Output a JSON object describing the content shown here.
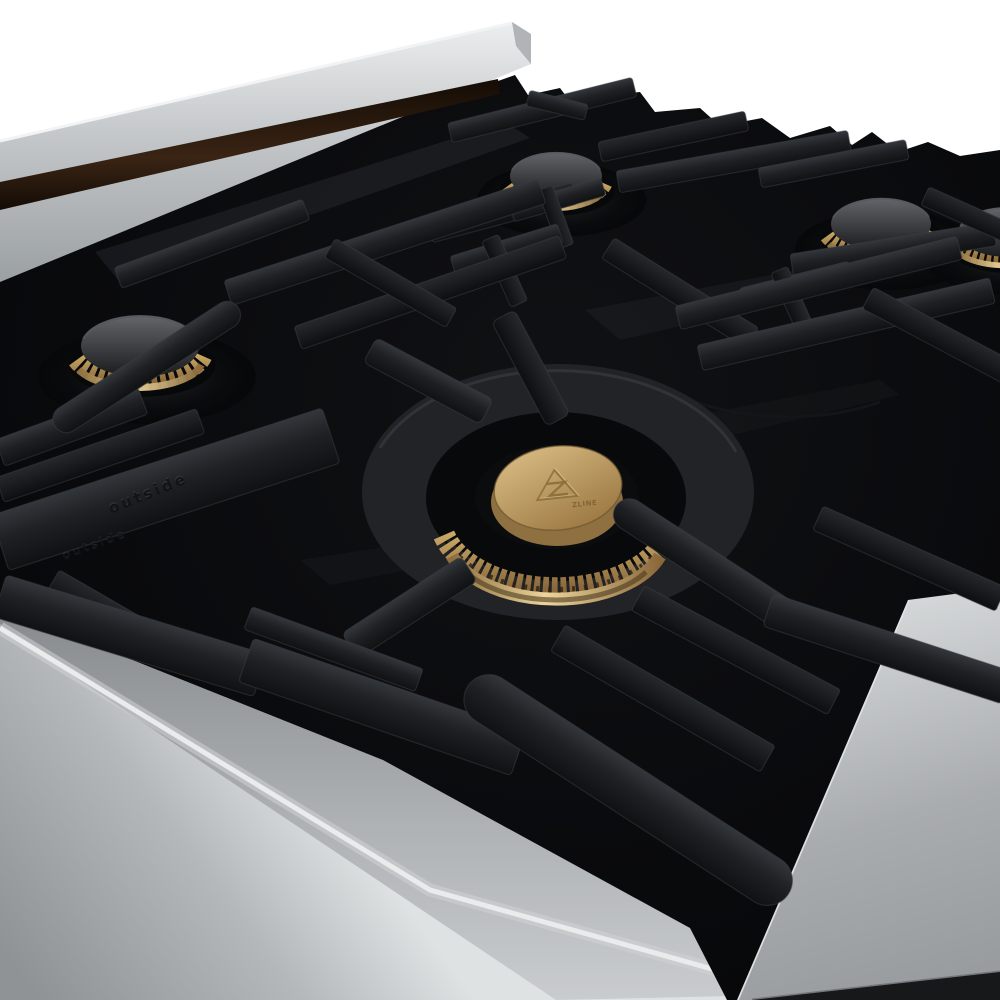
{
  "meta": {
    "description": "Close-up product photograph of a stainless steel gas rangetop with a black porcelain cooktop, matte black cast-iron grates and brushed brass burners on a white background",
    "background": "white"
  },
  "branding": {
    "engraving": "ZLINE",
    "logo_name": "Z mountain emblem engraved on brass burner cap"
  },
  "grate_embossing": {
    "text": "outside"
  },
  "colors": {
    "background": "#ffffff",
    "steel_top": "#eceeef",
    "steel_mid": "#c3c6c8",
    "steel_low": "#9ba0a3",
    "gap_brown_light": "#3a2414",
    "gap_brown_dark": "#140c05",
    "black_surface": "#0a0b0d",
    "grate_hi": "#33363b",
    "grate_mid": "#1e2023",
    "grate_lo": "#101113",
    "grate_edge": "#43464c",
    "panel_hi": "#e9ebec",
    "panel_mid": "#b5b8ba",
    "panel_lo": "#8f9396",
    "brass_tex_hi": "#c9a765",
    "brass_tex_lo": "#8a683a",
    "brass_polish": "#ecd49c",
    "brass_cap_hi": "#dcc088",
    "brass_cap_lo": "#a07c46",
    "brass_engrave": "#8a6b38",
    "cap_gray_hi": "#63666a",
    "cap_gray_lo": "#1a1b1d",
    "corner_dark": "#17181a"
  },
  "scene": {
    "product": "gas rangetop close-up",
    "burners": {
      "rear_left": {
        "label": "rear-left burner",
        "cx": 556,
        "cy": 176,
        "scale": 0.92
      },
      "rear_right": {
        "label": "rear-right burner",
        "cx": 881,
        "cy": 224,
        "scale": 1.0
      },
      "right_edge": {
        "label": "right-edge burner (partially cropped)",
        "cx": 1006,
        "cy": 232,
        "scale": 0.95
      },
      "mid_left": {
        "label": "mid-left burner",
        "cx": 140,
        "cy": 346,
        "scale": 1.18
      },
      "center": {
        "label": "center dual brass burner with engraved cap",
        "cx": 558,
        "cy": 497,
        "scale": 1.0
      }
    }
  }
}
